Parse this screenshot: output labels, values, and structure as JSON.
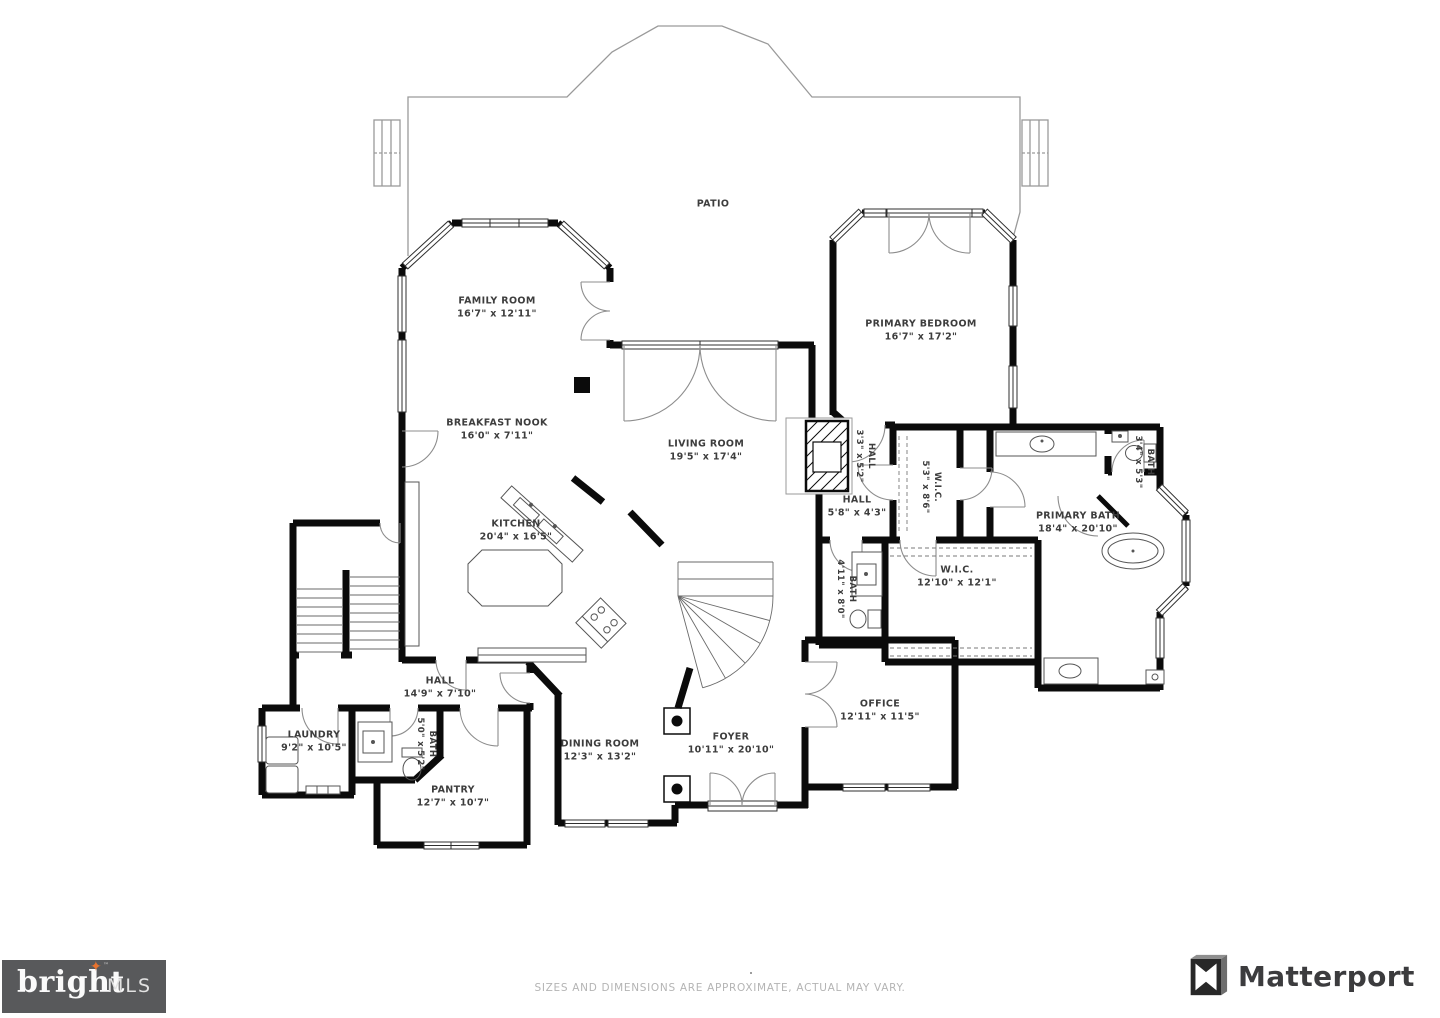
{
  "floorplan": {
    "labels": [
      {
        "id": "patio",
        "name": "PATIO",
        "dims": "",
        "x": 713,
        "y": 204,
        "rotate": 0,
        "small": false
      },
      {
        "id": "family-room",
        "name": "FAMILY ROOM",
        "dims": "16'7\" x 12'11\"",
        "x": 497,
        "y": 308,
        "rotate": 0,
        "small": false
      },
      {
        "id": "primary-bedroom",
        "name": "PRIMARY BEDROOM",
        "dims": "16'7\" x 17'2\"",
        "x": 921,
        "y": 331,
        "rotate": 0,
        "small": false
      },
      {
        "id": "breakfast-nook",
        "name": "BREAKFAST NOOK",
        "dims": "16'0\" x 7'11\"",
        "x": 497,
        "y": 430,
        "rotate": 0,
        "small": false
      },
      {
        "id": "living-room",
        "name": "LIVING ROOM",
        "dims": "19'5\" x 17'4\"",
        "x": 706,
        "y": 451,
        "rotate": 0,
        "small": false
      },
      {
        "id": "hall-upper",
        "name": "HALL",
        "dims": "5'8\" x 4'3\"",
        "x": 857,
        "y": 507,
        "rotate": 0,
        "small": false
      },
      {
        "id": "hall-inner",
        "name": "HALL",
        "dims": "3'3\" x 5'2\"",
        "x": 864,
        "y": 456,
        "rotate": 90,
        "small": true
      },
      {
        "id": "kitchen",
        "name": "KITCHEN",
        "dims": "20'4\" x 16'5\"",
        "x": 516,
        "y": 531,
        "rotate": 0,
        "small": false
      },
      {
        "id": "wic-small",
        "name": "W.I.C.",
        "dims": "5'3\" x 8'6\"",
        "x": 930,
        "y": 487,
        "rotate": 90,
        "small": true
      },
      {
        "id": "bath-small",
        "name": "BATH",
        "dims": "3'4\" x 5'3\"",
        "x": 1143,
        "y": 462,
        "rotate": 90,
        "small": true
      },
      {
        "id": "primary-bath",
        "name": "PRIMARY BATH",
        "dims": "18'4\" x 20'10\"",
        "x": 1078,
        "y": 523,
        "rotate": 0,
        "small": false
      },
      {
        "id": "bath-hall",
        "name": "BATH",
        "dims": "4'11\" x 8'0\"",
        "x": 845,
        "y": 589,
        "rotate": 90,
        "small": true
      },
      {
        "id": "wic-large",
        "name": "W.I.C.",
        "dims": "12'10\" x 12'1\"",
        "x": 957,
        "y": 577,
        "rotate": 0,
        "small": false
      },
      {
        "id": "hall-lower",
        "name": "HALL",
        "dims": "14'9\" x 7'10\"",
        "x": 440,
        "y": 688,
        "rotate": 0,
        "small": false
      },
      {
        "id": "laundry",
        "name": "LAUNDRY",
        "dims": "9'2\" x 10'5\"",
        "x": 314,
        "y": 742,
        "rotate": 0,
        "small": false
      },
      {
        "id": "bath-lower",
        "name": "BATH",
        "dims": "5'0\" x 5'2\"",
        "x": 425,
        "y": 744,
        "rotate": 90,
        "small": true
      },
      {
        "id": "office",
        "name": "OFFICE",
        "dims": "12'11\" x 11'5\"",
        "x": 880,
        "y": 711,
        "rotate": 0,
        "small": false
      },
      {
        "id": "dining-room",
        "name": "DINING ROOM",
        "dims": "12'3\" x 13'2\"",
        "x": 600,
        "y": 751,
        "rotate": 0,
        "small": false
      },
      {
        "id": "foyer",
        "name": "FOYER",
        "dims": "10'11\" x 20'10\"",
        "x": 731,
        "y": 744,
        "rotate": 0,
        "small": false
      },
      {
        "id": "pantry",
        "name": "PANTRY",
        "dims": "12'7\" x 10'7\"",
        "x": 453,
        "y": 797,
        "rotate": 0,
        "small": false
      }
    ]
  },
  "footer": {
    "disclaimer": "SIZES AND DIMENSIONS ARE APPROXIMATE, ACTUAL MAY VARY."
  },
  "logos": {
    "bright_mls": {
      "word": "bright",
      "suffix": "MLS",
      "tm": "™",
      "star_glyph": "✦",
      "bg": "#58595b",
      "star_color": "#e8732e"
    },
    "matterport": {
      "word": "Matterport",
      "color": "#3c3c3e"
    }
  }
}
